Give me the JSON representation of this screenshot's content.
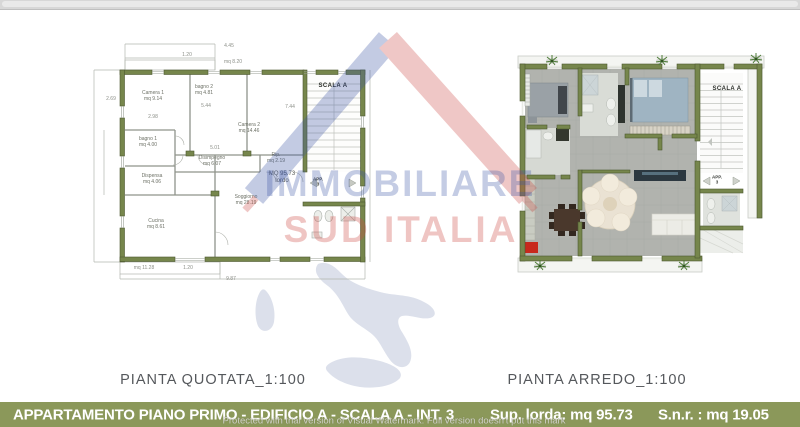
{
  "watermark": {
    "brand_line1": "IMMOBILIARE",
    "brand_line2": "SUD ITALIA",
    "protect_text": "Protected with trial version of Visual Watermark. Full version doesn't put this mark",
    "colors": {
      "blue": "#3c55a5",
      "red": "#cc4a44",
      "map_gray": "#dce0eb"
    }
  },
  "left_plan": {
    "title": "PIANTA QUOTATA_1:100",
    "scala_label": "SCALA A",
    "app_label_line1": "APP.",
    "app_label_line2": "3",
    "area_note_line1": "MQ 95.73",
    "area_note_line2": "lordo",
    "rooms": [
      {
        "name": "Camera 1",
        "area": "mq 9.14"
      },
      {
        "name": "bagno 2",
        "area": "mq 4.81"
      },
      {
        "name": "Camera 2",
        "area": "mq 14.46"
      },
      {
        "name": "bagno 1",
        "area": "mq 4.00"
      },
      {
        "name": "Disimpegno",
        "area": "mq 6.07"
      },
      {
        "name": "Rip.",
        "area": "mq 2.19"
      },
      {
        "name": "Dispensa",
        "area": "mq 4.06"
      },
      {
        "name": "Cucina",
        "area": "mq 8.61"
      },
      {
        "name": "Soggiorno",
        "area": "mq 28.19"
      }
    ],
    "dims": [
      "4.45",
      "1.20",
      "mq 8.20",
      "2.69",
      "5.44",
      "7.44",
      "5.01",
      "2.98",
      "mq 11.28",
      "1.20",
      "9.87"
    ]
  },
  "right_plan": {
    "title": "PIANTA ARREDO_1:100",
    "scala_label": "SCALA A",
    "app_label_line1": "APP.",
    "app_label_line2": "3"
  },
  "footer": {
    "left_text": "APPARTAMENTO PIANO PRIMO - EDIFICIO  A - SCALA A - INT. 3",
    "sup_lorda": "Sup. lorda: mq 95.73",
    "snr": "S.n.r. : mq 19.05",
    "bg_color": "#8b985a"
  }
}
